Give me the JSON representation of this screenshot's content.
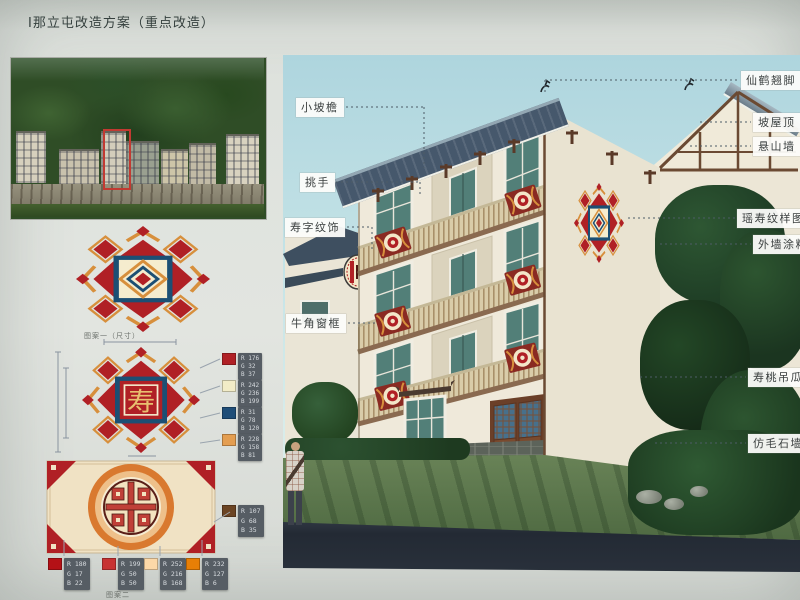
{
  "page": {
    "title": "Ⅰ那立屯改造方案（重点改造）"
  },
  "annotations": {
    "left": [
      {
        "text": "小坡檐"
      },
      {
        "text": "挑手"
      },
      {
        "text": "寿字纹饰"
      },
      {
        "text": "牛角窗框"
      }
    ],
    "right": [
      {
        "text": "仙鹤翘脚"
      },
      {
        "text": "坡屋顶"
      },
      {
        "text": "悬山墙"
      },
      {
        "text": "瑶寿纹样图案"
      },
      {
        "text": "外墙涂料"
      },
      {
        "text": "寿桃吊瓜柱"
      },
      {
        "text": "仿毛石墙裙"
      }
    ]
  },
  "patterns": {
    "caption_star": "图案一（尺寸）",
    "caption_panel": "图案二",
    "shou_char": "寿",
    "star_colors": {
      "red": "#b02025",
      "blue": "#1c4f74",
      "tan": "#d78f3c",
      "cream": "#f5ecce"
    },
    "star_swatches": [
      {
        "name": "red",
        "hex": "#b02025",
        "rows": [
          "R 176",
          "G 32",
          "B 37"
        ]
      },
      {
        "name": "cream",
        "hex": "#f2ecc7",
        "rows": [
          "R 242",
          "G 236",
          "B 199"
        ]
      },
      {
        "name": "blue",
        "hex": "#1f4e78",
        "rows": [
          "R 31",
          "G 78",
          "B 120"
        ]
      },
      {
        "name": "orange",
        "hex": "#e49e51",
        "rows": [
          "R 228",
          "G 158",
          "B 81"
        ]
      }
    ],
    "panel_swatches": [
      {
        "name": "deep-red",
        "hex": "#b41116",
        "rows": [
          "R 180",
          "G 17",
          "B 22"
        ]
      },
      {
        "name": "red",
        "hex": "#c73232",
        "rows": [
          "R 199",
          "G 50",
          "B 50"
        ]
      },
      {
        "name": "cream",
        "hex": "#fcd8a8",
        "rows": [
          "R 252",
          "G 216",
          "B 168"
        ]
      },
      {
        "name": "orange",
        "hex": "#e87f06",
        "rows": [
          "R 232",
          "G 127",
          "B 6"
        ]
      }
    ],
    "brown_swatch": {
      "name": "brown",
      "hex": "#6b4423",
      "rows": [
        "R 107",
        "G 68",
        "B 35"
      ]
    }
  },
  "photo": {
    "highlight_color": "#c23a32"
  },
  "rendering": {
    "sky": "#b3d8e0",
    "wall": "#efe9da",
    "roof": "#46586c",
    "accent_red": "#b02025"
  }
}
